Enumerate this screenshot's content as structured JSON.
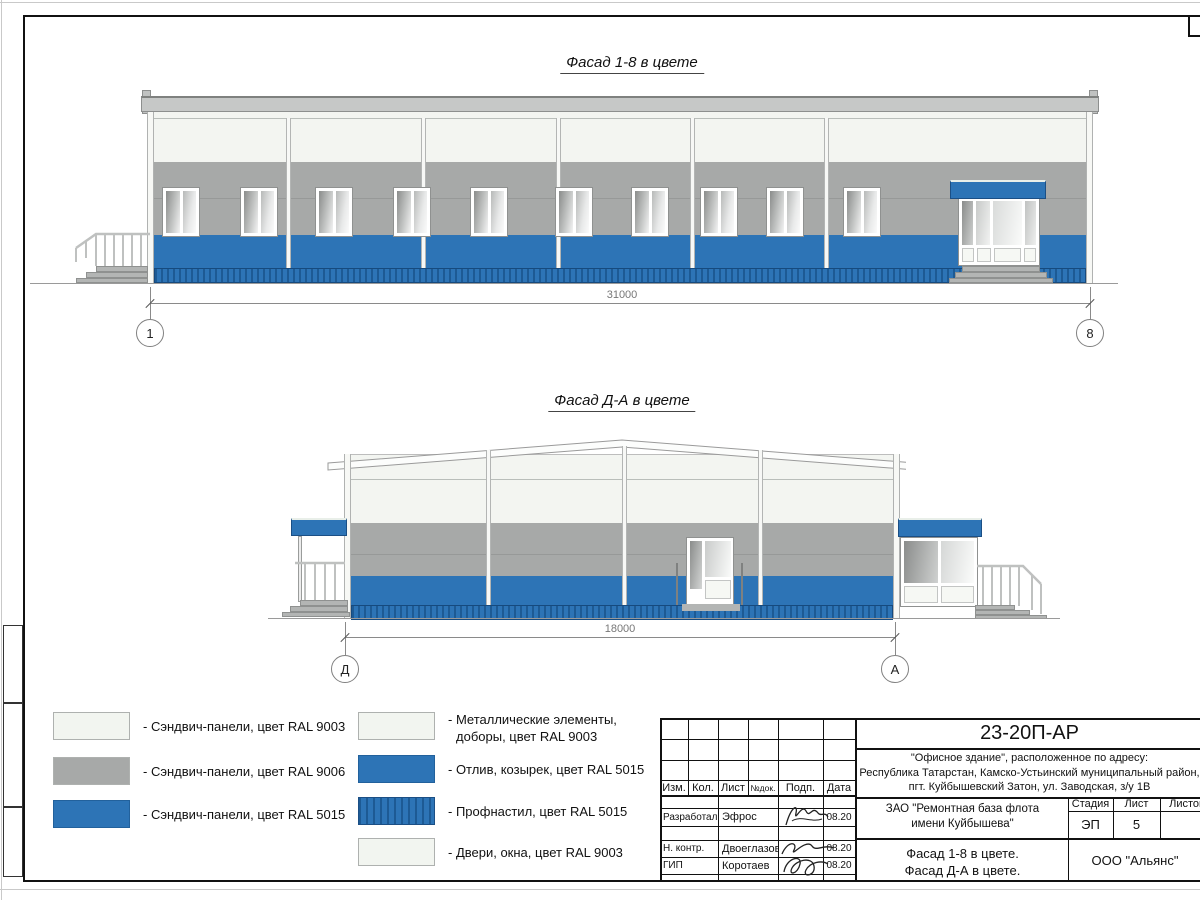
{
  "facades": {
    "f1": {
      "title": "Фасад 1-8 в цвете",
      "dim": "31000",
      "axis_left": "1",
      "axis_right": "8"
    },
    "f2": {
      "title": "Фасад Д-А в цвете",
      "dim": "18000",
      "axis_left": "Д",
      "axis_right": "А"
    }
  },
  "legend": {
    "left": [
      {
        "label": "- Сэндвич-панели, цвет RAL 9003"
      },
      {
        "label": "- Сэндвич-панели, цвет RAL 9006"
      },
      {
        "label": "- Сэндвич-панели, цвет RAL 5015"
      }
    ],
    "right": [
      {
        "label": "- Металлические элементы,",
        "label2": "доборы, цвет RAL 9003"
      },
      {
        "label": "- Отлив, козырек, цвет RAL 5015"
      },
      {
        "label": "- Профнастил, цвет RAL 5015"
      },
      {
        "label": "- Двери, окна, цвет RAL 9003"
      }
    ]
  },
  "titleblock": {
    "doc_number": "23-20П-АР",
    "address_line1": "\"Офисное здание\", расположенное по адресу:",
    "address_line2": "Республика Татарстан, Камско-Устьинский муниципальный район,",
    "address_line3": "пгт. Куйбышевский Затон, ул. Заводская, з/у 1В",
    "cols": [
      "Изм.",
      "Кол.",
      "Лист",
      "№док.",
      "Подп.",
      "Дата"
    ],
    "rows": [
      {
        "role": "Разработал",
        "name": "Эфрос",
        "date": "08.20"
      },
      {
        "role": "Н. контр.",
        "name": "Двоеглазов",
        "date": "08.20"
      },
      {
        "role": "ГИП",
        "name": "Коротаев",
        "date": "08.20"
      }
    ],
    "client_line1": "ЗАО \"Ремонтная база флота",
    "client_line2": "имени Куйбышева\"",
    "stage_label": "Стадия",
    "sheet_label": "Лист",
    "sheets_label": "Листов",
    "stage_value": "ЭП",
    "sheet_value": "5",
    "sheet_title_line1": "Фасад 1-8 в цвете.",
    "sheet_title_line2": "Фасад Д-А в цвете.",
    "company": "ООО \"Альянс\""
  },
  "colors": {
    "panel_white": "#f3f5f1",
    "panel_gray": "#a7a9a8",
    "panel_blue": "#2d74b6",
    "roof_gray": "#c6c8c7"
  }
}
